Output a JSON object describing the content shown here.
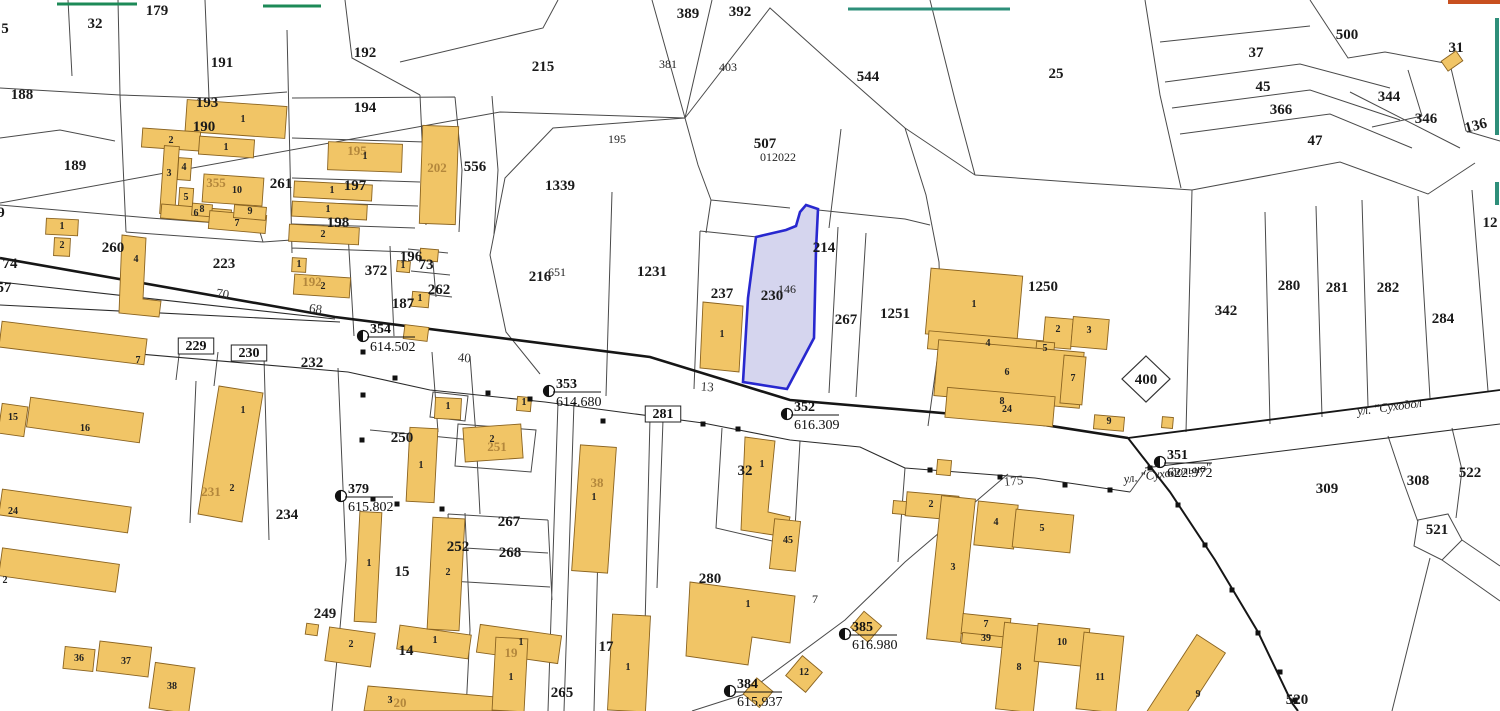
{
  "map": {
    "selected_parcel": {
      "primary_label": "230",
      "secondary_label": "146"
    },
    "colors": {
      "building_fill": "#f1c566",
      "building_stroke": "#8a6320",
      "boundary": "#4a4a4a",
      "road": "#161616",
      "selected_fill": "#c9c9e9",
      "selected_stroke": "#2828cf",
      "faded_label": "#b3873c",
      "label": "#1a1a1a",
      "green_mark": "#1d8a57",
      "teal_mark": "#2e8f7a",
      "orange_mark": "#c85020"
    },
    "labels": {
      "parcels": [
        {
          "t": "5",
          "x": 5,
          "y": 33
        },
        {
          "t": "32",
          "x": 95,
          "y": 28
        },
        {
          "t": "179",
          "x": 157,
          "y": 15
        },
        {
          "t": "188",
          "x": 22,
          "y": 99
        },
        {
          "t": "191",
          "x": 222,
          "y": 67
        },
        {
          "t": "192",
          "x": 365,
          "y": 57
        },
        {
          "t": "193",
          "x": 207,
          "y": 107
        },
        {
          "t": "190",
          "x": 204,
          "y": 131
        },
        {
          "t": "194",
          "x": 365,
          "y": 112
        },
        {
          "t": "189",
          "x": 75,
          "y": 170
        },
        {
          "t": "215",
          "x": 543,
          "y": 71
        },
        {
          "t": "389",
          "x": 688,
          "y": 18
        },
        {
          "t": "392",
          "x": 740,
          "y": 16
        },
        {
          "t": "544",
          "x": 868,
          "y": 81
        },
        {
          "t": "25",
          "x": 1056,
          "y": 78
        },
        {
          "t": "507",
          "x": 765,
          "y": 148
        },
        {
          "t": "1339",
          "x": 560,
          "y": 190
        },
        {
          "t": "216",
          "x": 540,
          "y": 281
        },
        {
          "t": "1231",
          "x": 652,
          "y": 276
        },
        {
          "t": "237",
          "x": 722,
          "y": 298
        },
        {
          "t": "214",
          "x": 824,
          "y": 252
        },
        {
          "t": "267",
          "x": 846,
          "y": 324
        },
        {
          "t": "1251",
          "x": 895,
          "y": 318
        },
        {
          "t": "1250",
          "x": 1043,
          "y": 291
        },
        {
          "t": "556",
          "x": 475,
          "y": 171
        },
        {
          "t": "261",
          "x": 281,
          "y": 188
        },
        {
          "t": "197",
          "x": 355,
          "y": 190
        },
        {
          "t": "198",
          "x": 338,
          "y": 227
        },
        {
          "t": "260",
          "x": 113,
          "y": 252
        },
        {
          "t": "223",
          "x": 224,
          "y": 268
        },
        {
          "t": "372",
          "x": 376,
          "y": 275
        },
        {
          "t": "196",
          "x": 411,
          "y": 261
        },
        {
          "t": "73",
          "x": 426,
          "y": 269
        },
        {
          "t": "262",
          "x": 439,
          "y": 294
        },
        {
          "t": "187",
          "x": 403,
          "y": 308
        },
        {
          "t": "342",
          "x": 1226,
          "y": 315
        },
        {
          "t": "280",
          "x": 1289,
          "y": 290
        },
        {
          "t": "281",
          "x": 1337,
          "y": 292
        },
        {
          "t": "282",
          "x": 1388,
          "y": 292
        },
        {
          "t": "284",
          "x": 1443,
          "y": 323
        },
        {
          "t": "37",
          "x": 1256,
          "y": 57
        },
        {
          "t": "500",
          "x": 1347,
          "y": 39
        },
        {
          "t": "45",
          "x": 1263,
          "y": 91
        },
        {
          "t": "366",
          "x": 1281,
          "y": 114
        },
        {
          "t": "344",
          "x": 1389,
          "y": 101
        },
        {
          "t": "346",
          "x": 1426,
          "y": 123
        },
        {
          "t": "47",
          "x": 1315,
          "y": 145
        },
        {
          "t": "136",
          "x": 1477,
          "y": 130,
          "r": -15
        },
        {
          "t": "31",
          "x": 1456,
          "y": 52
        },
        {
          "t": "400",
          "x": 1146,
          "y": 384,
          "s": 14
        },
        {
          "t": "309",
          "x": 1327,
          "y": 493
        },
        {
          "t": "308",
          "x": 1418,
          "y": 485
        },
        {
          "t": "522",
          "x": 1470,
          "y": 477
        },
        {
          "t": "521",
          "x": 1437,
          "y": 534
        },
        {
          "t": "520",
          "x": 1297,
          "y": 704
        },
        {
          "t": "232",
          "x": 312,
          "y": 367
        },
        {
          "t": "234",
          "x": 287,
          "y": 519
        },
        {
          "t": "249",
          "x": 325,
          "y": 618
        },
        {
          "t": "250",
          "x": 402,
          "y": 442
        },
        {
          "t": "252",
          "x": 458,
          "y": 551
        },
        {
          "t": "267",
          "x": 509,
          "y": 526
        },
        {
          "t": "268",
          "x": 510,
          "y": 557
        },
        {
          "t": "15",
          "x": 402,
          "y": 576
        },
        {
          "t": "14",
          "x": 406,
          "y": 655
        },
        {
          "t": "17",
          "x": 606,
          "y": 651
        },
        {
          "t": "265",
          "x": 562,
          "y": 697
        },
        {
          "t": "280",
          "x": 710,
          "y": 583
        },
        {
          "t": "32",
          "x": 745,
          "y": 475
        },
        {
          "t": "230",
          "x": 772,
          "y": 300,
          "s": 19
        },
        {
          "t": "9",
          "x": 1,
          "y": 217
        },
        {
          "t": "74",
          "x": 10,
          "y": 268
        },
        {
          "t": "57",
          "x": 4,
          "y": 292,
          "s": 17
        },
        {
          "t": "12",
          "x": 1490,
          "y": 227
        }
      ],
      "parcels_small": [
        {
          "t": "381",
          "x": 668,
          "y": 68
        },
        {
          "t": "403",
          "x": 728,
          "y": 71
        },
        {
          "t": "195",
          "x": 617,
          "y": 143
        },
        {
          "t": "651",
          "x": 557,
          "y": 276
        },
        {
          "t": "012022",
          "x": 778,
          "y": 161
        },
        {
          "t": "146",
          "x": 787,
          "y": 293
        },
        {
          "t": "7",
          "x": 815,
          "y": 603
        }
      ],
      "parcels_faded": [
        {
          "t": "355",
          "x": 216,
          "y": 187
        },
        {
          "t": "195",
          "x": 357,
          "y": 155
        },
        {
          "t": "202",
          "x": 437,
          "y": 172
        },
        {
          "t": "192",
          "x": 312,
          "y": 286
        },
        {
          "t": "231",
          "x": 211,
          "y": 496
        },
        {
          "t": "251",
          "x": 497,
          "y": 451
        },
        {
          "t": "38",
          "x": 597,
          "y": 487
        },
        {
          "t": "19",
          "x": 511,
          "y": 657
        },
        {
          "t": "20",
          "x": 400,
          "y": 707
        }
      ],
      "boxed": [
        {
          "t": "229",
          "x": 196,
          "y": 350
        },
        {
          "t": "230",
          "x": 249,
          "y": 357
        },
        {
          "t": "281",
          "x": 663,
          "y": 418
        }
      ],
      "roads": [
        {
          "t": "70",
          "x": 222,
          "y": 298,
          "r": 9
        },
        {
          "t": "68",
          "x": 315,
          "y": 313,
          "r": 8
        },
        {
          "t": "40",
          "x": 464,
          "y": 362,
          "r": 5
        },
        {
          "t": "13",
          "x": 707,
          "y": 391,
          "r": 4
        },
        {
          "t": "175",
          "x": 1014,
          "y": 485,
          "r": -6
        }
      ],
      "streets": [
        {
          "t": "ул. \"Суходол",
          "x": 1390,
          "y": 411,
          "r": -7.5
        },
        {
          "t": "ул. \"Суходольно\"",
          "x": 1168,
          "y": 477,
          "r": -8
        }
      ],
      "buildings": [
        {
          "t": "1",
          "x": 243,
          "y": 122
        },
        {
          "t": "2",
          "x": 171,
          "y": 143
        },
        {
          "t": "1",
          "x": 226,
          "y": 150
        },
        {
          "t": "3",
          "x": 169,
          "y": 176
        },
        {
          "t": "4",
          "x": 184,
          "y": 170
        },
        {
          "t": "5",
          "x": 186,
          "y": 200
        },
        {
          "t": "10",
          "x": 237,
          "y": 193
        },
        {
          "t": "6",
          "x": 196,
          "y": 216
        },
        {
          "t": "8",
          "x": 202,
          "y": 212
        },
        {
          "t": "7",
          "x": 237,
          "y": 226
        },
        {
          "t": "9",
          "x": 250,
          "y": 214
        },
        {
          "t": "1",
          "x": 365,
          "y": 159
        },
        {
          "t": "1",
          "x": 332,
          "y": 193
        },
        {
          "t": "1",
          "x": 328,
          "y": 212
        },
        {
          "t": "2",
          "x": 323,
          "y": 237
        },
        {
          "t": "1",
          "x": 299,
          "y": 267
        },
        {
          "t": "2",
          "x": 323,
          "y": 289
        },
        {
          "t": "1",
          "x": 420,
          "y": 301
        },
        {
          "t": "1",
          "x": 403,
          "y": 268
        },
        {
          "t": "1",
          "x": 62,
          "y": 229
        },
        {
          "t": "2",
          "x": 62,
          "y": 248
        },
        {
          "t": "4",
          "x": 136,
          "y": 262
        },
        {
          "t": "7",
          "x": 138,
          "y": 363
        },
        {
          "t": "15",
          "x": 13,
          "y": 420
        },
        {
          "t": "16",
          "x": 85,
          "y": 431
        },
        {
          "t": "24",
          "x": 13,
          "y": 514
        },
        {
          "t": "2",
          "x": 5,
          "y": 583
        },
        {
          "t": "1",
          "x": 243,
          "y": 413
        },
        {
          "t": "2",
          "x": 232,
          "y": 491
        },
        {
          "t": "36",
          "x": 79,
          "y": 661
        },
        {
          "t": "37",
          "x": 126,
          "y": 664
        },
        {
          "t": "38",
          "x": 172,
          "y": 689
        },
        {
          "t": "2",
          "x": 351,
          "y": 647
        },
        {
          "t": "1",
          "x": 435,
          "y": 643
        },
        {
          "t": "1",
          "x": 521,
          "y": 645
        },
        {
          "t": "3",
          "x": 390,
          "y": 703
        },
        {
          "t": "1",
          "x": 369,
          "y": 566
        },
        {
          "t": "2",
          "x": 448,
          "y": 575
        },
        {
          "t": "2",
          "x": 492,
          "y": 442
        },
        {
          "t": "1",
          "x": 421,
          "y": 468
        },
        {
          "t": "1",
          "x": 448,
          "y": 409
        },
        {
          "t": "1",
          "x": 594,
          "y": 500
        },
        {
          "t": "1",
          "x": 511,
          "y": 680
        },
        {
          "t": "1",
          "x": 628,
          "y": 670
        },
        {
          "t": "1",
          "x": 762,
          "y": 467
        },
        {
          "t": "1",
          "x": 748,
          "y": 607
        },
        {
          "t": "45",
          "x": 788,
          "y": 543
        },
        {
          "t": "12",
          "x": 804,
          "y": 675
        },
        {
          "t": "2",
          "x": 931,
          "y": 507
        },
        {
          "t": "3",
          "x": 953,
          "y": 570
        },
        {
          "t": "4",
          "x": 996,
          "y": 525
        },
        {
          "t": "5",
          "x": 1042,
          "y": 531
        },
        {
          "t": "7",
          "x": 986,
          "y": 627
        },
        {
          "t": "39",
          "x": 986,
          "y": 641
        },
        {
          "t": "8",
          "x": 1019,
          "y": 670
        },
        {
          "t": "10",
          "x": 1062,
          "y": 645
        },
        {
          "t": "11",
          "x": 1100,
          "y": 680
        },
        {
          "t": "9",
          "x": 1198,
          "y": 697
        },
        {
          "t": "1",
          "x": 974,
          "y": 307
        },
        {
          "t": "4",
          "x": 988,
          "y": 346
        },
        {
          "t": "2",
          "x": 1058,
          "y": 332
        },
        {
          "t": "3",
          "x": 1089,
          "y": 333
        },
        {
          "t": "5",
          "x": 1045,
          "y": 351
        },
        {
          "t": "6",
          "x": 1007,
          "y": 375
        },
        {
          "t": "7",
          "x": 1073,
          "y": 381
        },
        {
          "t": "8",
          "x": 1002,
          "y": 404
        },
        {
          "t": "24",
          "x": 1007,
          "y": 412
        },
        {
          "t": "9",
          "x": 1109,
          "y": 424
        },
        {
          "t": "1",
          "x": 722,
          "y": 337
        },
        {
          "t": "1",
          "x": 524,
          "y": 405
        }
      ]
    },
    "survey_points": [
      {
        "id": "354",
        "value": "614.502",
        "x": 363,
        "y": 336
      },
      {
        "id": "353",
        "value": "614.680",
        "x": 549,
        "y": 391
      },
      {
        "id": "352",
        "value": "616.309",
        "x": 787,
        "y": 414
      },
      {
        "id": "351",
        "value": "622.972",
        "x": 1160,
        "y": 462
      },
      {
        "id": "379",
        "value": "615.802",
        "x": 341,
        "y": 496
      },
      {
        "id": "385",
        "value": "616.980",
        "x": 845,
        "y": 634
      },
      {
        "id": "384",
        "value": "615.937",
        "x": 730,
        "y": 691
      }
    ]
  }
}
